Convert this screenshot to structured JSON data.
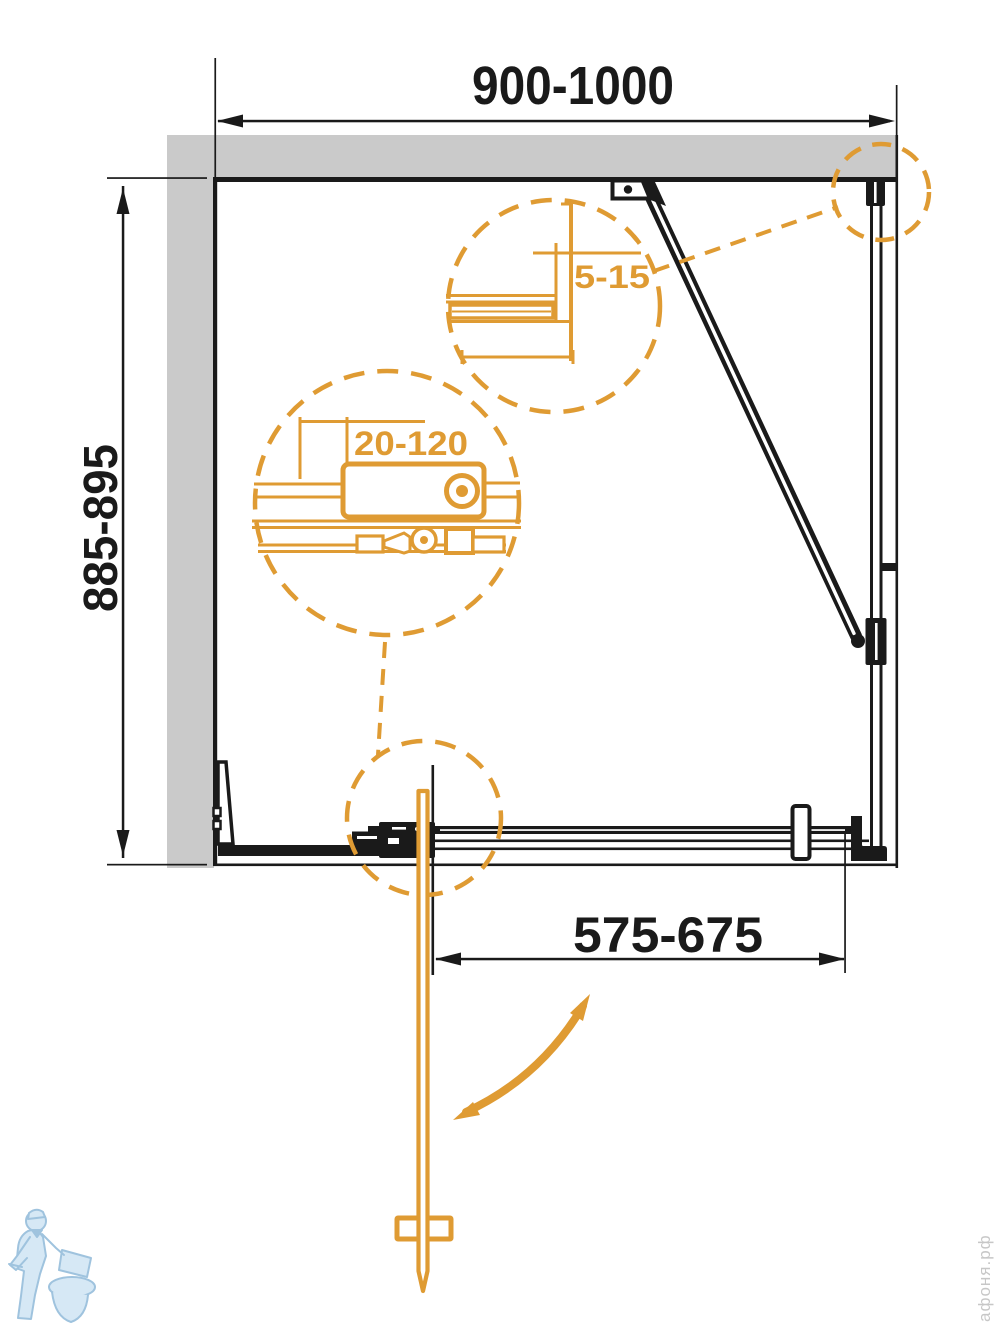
{
  "drawing": {
    "type": "shower-enclosure-plan-technical-drawing",
    "dimensions": {
      "overall_width": "900-1000",
      "overall_depth": "885-895",
      "door_width": "575-675",
      "wall_profile_adjust": "5-15",
      "bracket_adjust": "20-120"
    },
    "colors": {
      "accent_orange": "#DF9B33",
      "line_black": "#1a1a1a",
      "wall_gray": "#CACACA",
      "watermark_blue": "#D6E8F5",
      "watermark_gray": "#c7c7c7"
    },
    "watermark": {
      "site": "афоня.рф"
    }
  }
}
